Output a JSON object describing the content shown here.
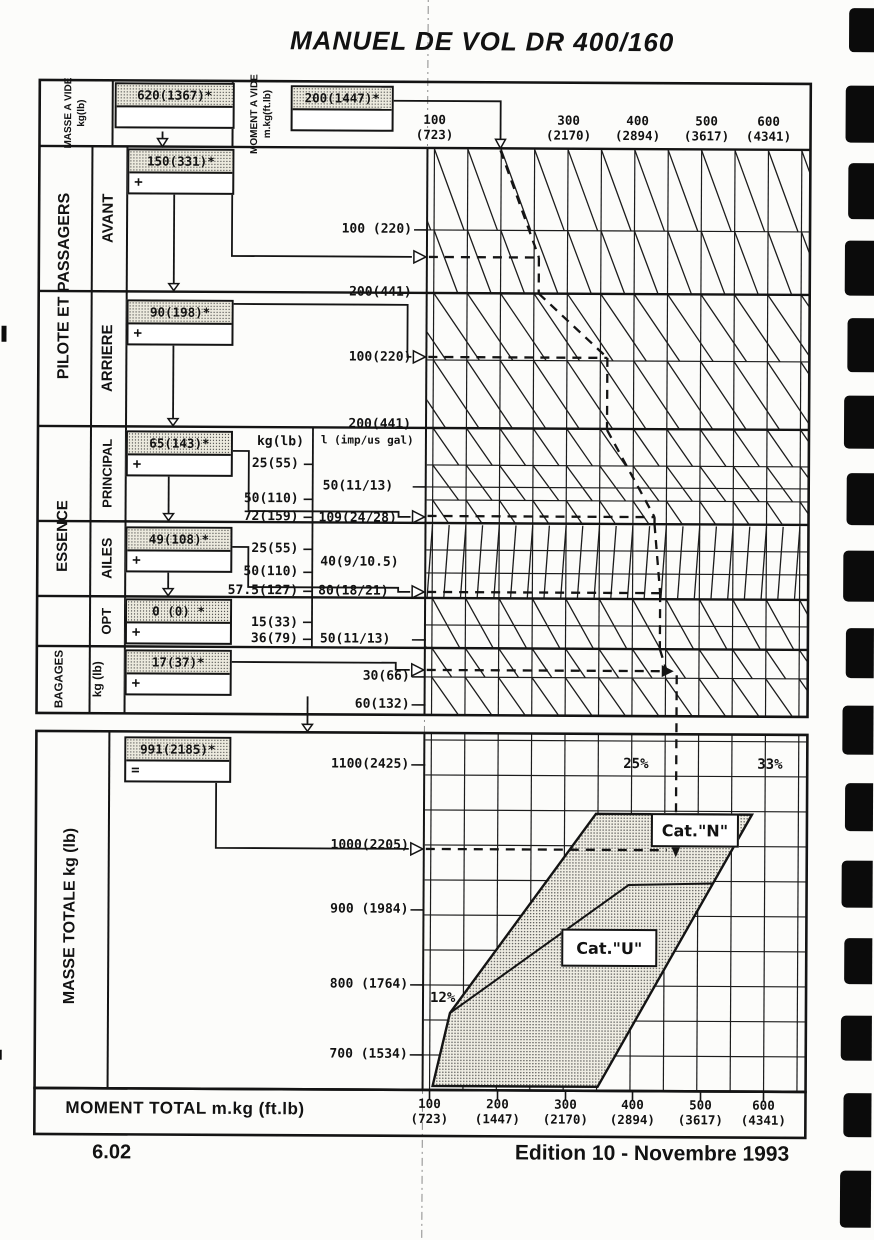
{
  "page": {
    "title": "MANUEL DE VOL DR 400/160",
    "page_number": "6.02",
    "edition": "Edition 10 - Novembre 1993"
  },
  "top": {
    "mass_label": "MASSE A VIDE",
    "mass_unit": "kg(lb)",
    "mass_value": "620(1367)*",
    "moment_label": "MOMENT A VIDE",
    "moment_unit": "m.kg(ft.lb)",
    "moment_value": "200(1447)*"
  },
  "rows": {
    "pilots_label": "PILOTE ET PASSAGERS",
    "front": {
      "label": "AVANT",
      "value": "150(331)*",
      "op": "+",
      "scale": [
        "100 (220)",
        "200(441)"
      ]
    },
    "rear": {
      "label": "ARRIERE",
      "value": "90(198)*",
      "op": "+",
      "scale": [
        "100(220)",
        "200(441)"
      ]
    },
    "fuel_label": "ESSENCE",
    "fuel_col_kg": "kg(lb)",
    "fuel_col_l": "l (imp/us gal)",
    "main": {
      "label": "PRINCIPAL",
      "value": "65(143)*",
      "op": "+",
      "kg": [
        "25(55)",
        "50(110)",
        "72(159)"
      ],
      "liters": [
        "50(11/13)",
        "109(24/28)"
      ]
    },
    "wings": {
      "label": "AILES",
      "value": "49(108)*",
      "op": "+",
      "kg": [
        "25(55)",
        "50(110)",
        "57.5(127)"
      ],
      "liters": [
        "40(9/10.5)",
        "80(18/21)"
      ]
    },
    "opt": {
      "label": "OPT",
      "value": "0 (0) *",
      "op": "+",
      "kg": [
        "15(33)",
        "36(79)"
      ],
      "liters": [
        "50(11/13)"
      ]
    },
    "baggage": {
      "label": "BAGAGES",
      "unit": "kg (lb)",
      "value": "17(37)*",
      "op": "+",
      "scale": [
        "30(66)",
        "60(132)"
      ]
    }
  },
  "total": {
    "label": "MASSE TOTALE kg (lb)",
    "value": "991(2185)*",
    "op": "=",
    "scale": [
      "1100(2425)",
      "1000(2205)",
      "900 (1984)",
      "800 (1764)",
      "700 (1534)"
    ]
  },
  "axes": {
    "top": [
      [
        "100",
        "(723)"
      ],
      [
        "300",
        "(2170)"
      ],
      [
        "400",
        "(2894)"
      ],
      [
        "500",
        "(3617)"
      ],
      [
        "600",
        "(4341)"
      ]
    ],
    "bottom_title": "MOMENT TOTAL m.kg (ft.lb)",
    "bottom": [
      [
        "100",
        "(723)"
      ],
      [
        "200",
        "(1447)"
      ],
      [
        "300",
        "(2170)"
      ],
      [
        "400",
        "(2894)"
      ],
      [
        "500",
        "(3617)"
      ],
      [
        "600",
        "(4341)"
      ]
    ]
  },
  "envelope": {
    "cat_n": "Cat.\"N\"",
    "cat_u": "Cat.\"U\"",
    "pct_12": "12%",
    "pct_25": "25%",
    "pct_33": "33%"
  },
  "chart_data": {
    "type": "nomograph-weight-and-balance",
    "title": "MANUEL DE VOL DR 400/160",
    "upper_moment_axis": {
      "unit": "m.kg (ft.lb)",
      "ticks": [
        [
          100,
          723
        ],
        [
          300,
          2170
        ],
        [
          400,
          2894
        ],
        [
          500,
          3617
        ],
        [
          600,
          4341
        ]
      ]
    },
    "lower_moment_axis": {
      "title": "MOMENT TOTAL m.kg (ft.lb)",
      "ticks": [
        [
          100,
          723
        ],
        [
          200,
          1447
        ],
        [
          300,
          2170
        ],
        [
          400,
          2894
        ],
        [
          500,
          3617
        ],
        [
          600,
          4341
        ]
      ]
    },
    "mass_axis": {
      "label": "MASSE TOTALE kg (lb)",
      "ticks": [
        [
          1100,
          2425
        ],
        [
          1000,
          2205
        ],
        [
          900,
          1984
        ],
        [
          800,
          1764
        ],
        [
          700,
          1534
        ]
      ]
    },
    "loading_rows": [
      {
        "item": "MASSE A VIDE kg(lb)",
        "value": "620(1367)*"
      },
      {
        "item": "MOMENT A VIDE m.kg(ft.lb)",
        "value": "200(1447)*"
      },
      {
        "item": "PILOTE ET PASSAGERS AVANT",
        "value": "150(331)*",
        "scale_kg": [
          "100 (220)",
          "200(441)"
        ]
      },
      {
        "item": "PILOTE ET PASSAGERS ARRIERE",
        "value": "90(198)*",
        "scale_kg": [
          "100(220)",
          "200(441)"
        ]
      },
      {
        "item": "ESSENCE PRINCIPAL",
        "value": "65(143)*",
        "scale_kg": [
          "25(55)",
          "50(110)",
          "72(159)"
        ],
        "scale_l": [
          "50(11/13)",
          "109(24/28)"
        ]
      },
      {
        "item": "ESSENCE AILES",
        "value": "49(108)*",
        "scale_kg": [
          "25(55)",
          "50(110)",
          "57.5(127)"
        ],
        "scale_l": [
          "40(9/10.5)",
          "80(18/21)"
        ]
      },
      {
        "item": "ESSENCE OPT",
        "value": "0 (0) *",
        "scale_kg": [
          "15(33)",
          "36(79)"
        ],
        "scale_l": [
          "50(11/13)"
        ]
      },
      {
        "item": "BAGAGES kg (lb)",
        "value": "17(37)*",
        "scale_kg": [
          "30(66)",
          "60(132)"
        ]
      },
      {
        "item": "MASSE TOTALE kg (lb)",
        "value": "991(2185)*"
      }
    ],
    "envelope": {
      "categories": [
        "Cat.\"N\"",
        "Cat.\"U\""
      ],
      "cg_limit_labels_pct": [
        12,
        25,
        33
      ]
    }
  }
}
